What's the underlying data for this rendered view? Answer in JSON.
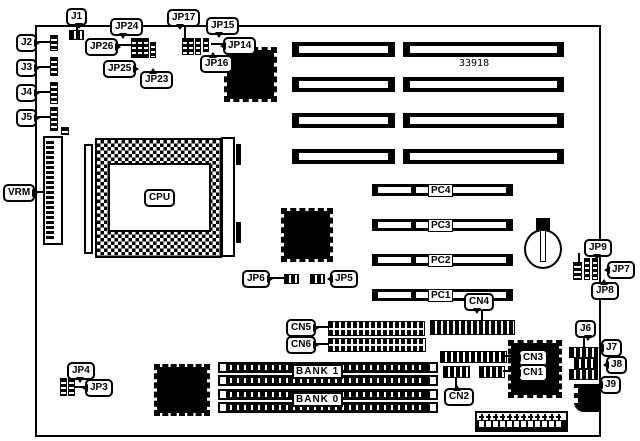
{
  "diagram": {
    "title": "motherboard-jumper-location-diagram",
    "part_number": "33918",
    "labels": {
      "j1": "J1",
      "j2": "J2",
      "j3": "J3",
      "j4": "J4",
      "j5": "J5",
      "vrm": "VRM",
      "cpu": "CPU",
      "jp24": "JP24",
      "jp26": "JP26",
      "jp25": "JP25",
      "jp23": "JP23",
      "jp17": "JP17",
      "jp15": "JP15",
      "jp14": "JP14",
      "jp16": "JP16",
      "jp6": "JP6",
      "jp5": "JP5",
      "jp9": "JP9",
      "jp7": "JP7",
      "jp8": "JP8",
      "jp4": "JP4",
      "jp3": "JP3",
      "pc4": "PC4",
      "pc3": "PC3",
      "pc2": "PC2",
      "pc1": "PC1",
      "cn5": "CN5",
      "cn6": "CN6",
      "cn4": "CN4",
      "cn3": "CN3",
      "cn1": "CN1",
      "cn2": "CN2",
      "j6": "J6",
      "j7": "J7",
      "j8": "J8",
      "j9": "J9",
      "bank1": "BANK 1",
      "bank0": "BANK 0"
    },
    "colors": {
      "line": "#000000",
      "background": "#ffffff"
    }
  }
}
